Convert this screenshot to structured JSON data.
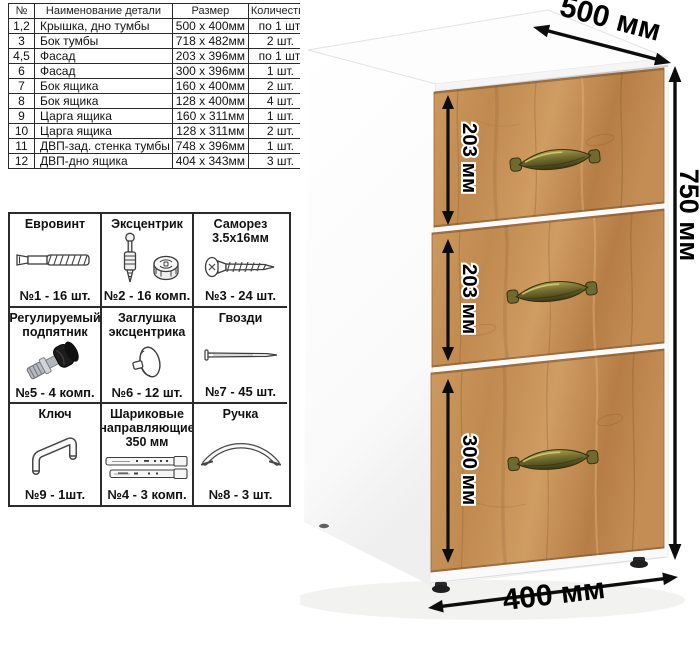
{
  "parts_table": {
    "headers": [
      "№",
      "Наименование детали",
      "Размер",
      "Количество"
    ],
    "rows": [
      {
        "num": "1,2",
        "name": "Крышка, дно тумбы",
        "size": "500 х 400мм",
        "qty": "по 1 шт."
      },
      {
        "num": "3",
        "name": "Бок тумбы",
        "size": "718 х 482мм",
        "qty": "2 шт."
      },
      {
        "num": "4,5",
        "name": "Фасад",
        "size": "203 х 396мм",
        "qty": "по 1 шт."
      },
      {
        "num": "6",
        "name": "Фасад",
        "size": "300 х 396мм",
        "qty": "1 шт."
      },
      {
        "num": "7",
        "name": "Бок ящика",
        "size": "160 х 400мм",
        "qty": "2 шт."
      },
      {
        "num": "8",
        "name": "Бок ящика",
        "size": "128 х 400мм",
        "qty": "4 шт."
      },
      {
        "num": "9",
        "name": "Царга ящика",
        "size": "160 х 311мм",
        "qty": "1 шт."
      },
      {
        "num": "10",
        "name": "Царга ящика",
        "size": "128 х 311мм",
        "qty": "2 шт."
      },
      {
        "num": "11",
        "name": "ДВП-зад. стенка тумбы",
        "size": "748 х 396мм",
        "qty": "1 шт."
      },
      {
        "num": "12",
        "name": "ДВП-дно ящика",
        "size": "404 х 343мм",
        "qty": "3 шт."
      }
    ]
  },
  "hardware": {
    "items": [
      {
        "title": "Евровинт",
        "count": "№1 - 16 шт.",
        "icon": "euro-screw-icon"
      },
      {
        "title": "Эксцентрик",
        "count": "№2 - 16 комп.",
        "icon": "cam-lock-icon"
      },
      {
        "title": "Саморез 3.5х16мм",
        "count": "№3 - 24 шт.",
        "icon": "self-tapping-screw-icon"
      },
      {
        "title": "Регулируемый подпятник",
        "count": "№5 - 4 комп.",
        "icon": "adjustable-foot-icon"
      },
      {
        "title": "Заглушка эксцентрика",
        "count": "№6 - 12 шт.",
        "icon": "cam-cover-icon"
      },
      {
        "title": "Гвозди",
        "count": "№7 - 45 шт.",
        "icon": "nail-icon"
      },
      {
        "title": "Ключ",
        "count": "№9 - 1шт.",
        "icon": "hex-key-icon"
      },
      {
        "title": "Шариковые направляющие 350 мм",
        "count": "№4 - 3 комп.",
        "icon": "ball-bearing-slides-icon"
      },
      {
        "title": "Ручка",
        "count": "№8 - 3 шт.",
        "icon": "handle-icon"
      }
    ]
  },
  "cabinet": {
    "dimensions": {
      "depth": "500 мм",
      "height": "750 мм",
      "width": "400 мм",
      "drawer_top": "203 мм",
      "drawer_middle": "203 мм",
      "drawer_bottom": "300 мм"
    },
    "colors": {
      "wood": "#c28b50",
      "handle_brass": "#6f6a2d",
      "body": "#fdfdfd"
    }
  }
}
